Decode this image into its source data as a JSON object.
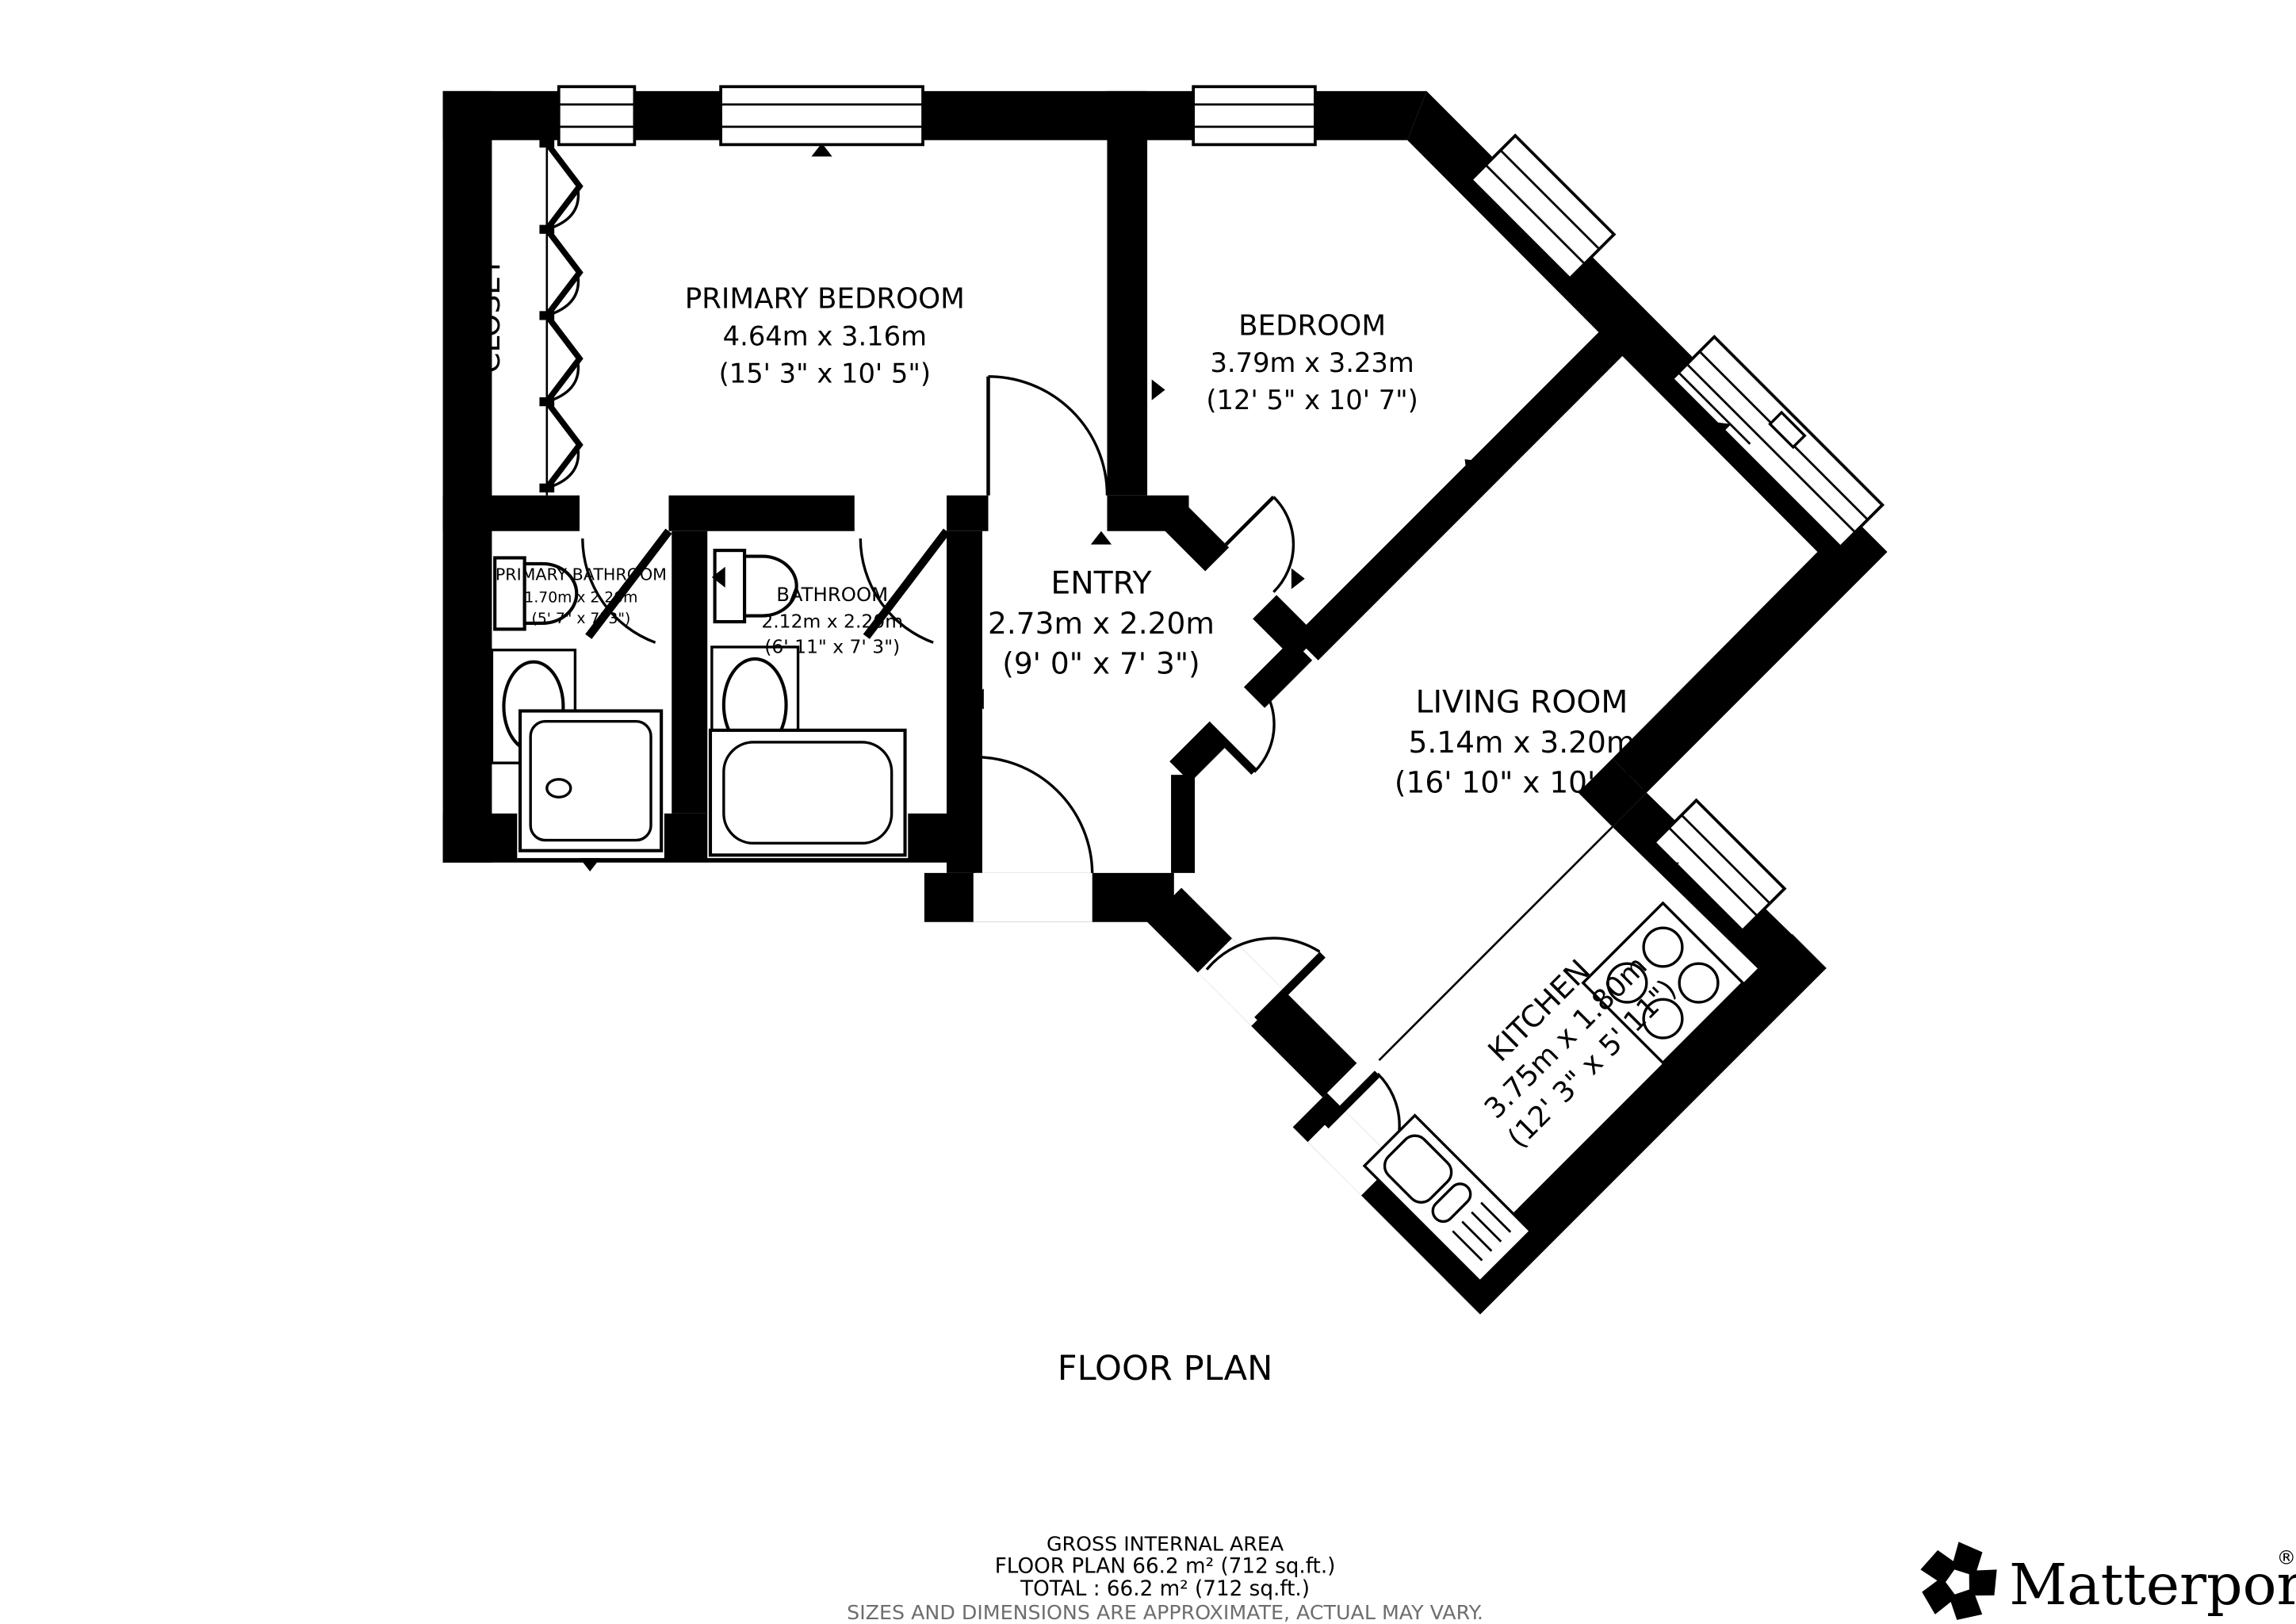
{
  "title": "FLOOR PLAN",
  "rooms": [
    {
      "id": "closet",
      "name": "CLOSET"
    },
    {
      "id": "primary-bedroom",
      "name": "PRIMARY BEDROOM",
      "metric": "4.64m x 3.16m",
      "imperial": "(15' 3\" x 10' 5\")"
    },
    {
      "id": "bedroom",
      "name": "BEDROOM",
      "metric": "3.79m x 3.23m",
      "imperial": "(12' 5\" x 10' 7\")"
    },
    {
      "id": "primary-bathroom",
      "name": "PRIMARY BATHROOM",
      "metric": "1.70m x 2.20m",
      "imperial": "(5' 7\" x 7' 3\")"
    },
    {
      "id": "bathroom",
      "name": "BATHROOM",
      "metric": "2.12m x 2.20m",
      "imperial": "(6' 11\" x 7' 3\")"
    },
    {
      "id": "entry",
      "name": "ENTRY",
      "metric": "2.73m x 2.20m",
      "imperial": "(9' 0\" x 7' 3\")"
    },
    {
      "id": "living-room",
      "name": "LIVING ROOM",
      "metric": "5.14m x 3.20m",
      "imperial": "(16' 10\" x 10' 6\")"
    },
    {
      "id": "kitchen",
      "name": "KITCHEN",
      "metric": "3.75m x 1.80m",
      "imperial": "(12' 3\" x 5' 11\")"
    }
  ],
  "footer": {
    "gross_area_label": "GROSS INTERNAL AREA",
    "floor_plan_area": "FLOOR PLAN 66.2 m² (712 sq.ft.)",
    "total_area": "TOTAL :  66.2 m² (712 sq.ft.)",
    "disclaimer": "SIZES AND DIMENSIONS ARE APPROXIMATE, ACTUAL MAY VARY."
  },
  "brand": {
    "name": "Matterport",
    "registered": "®"
  },
  "colors": {
    "wall": "#000000",
    "background": "#ffffff",
    "muted_text": "#6e6e6e"
  }
}
